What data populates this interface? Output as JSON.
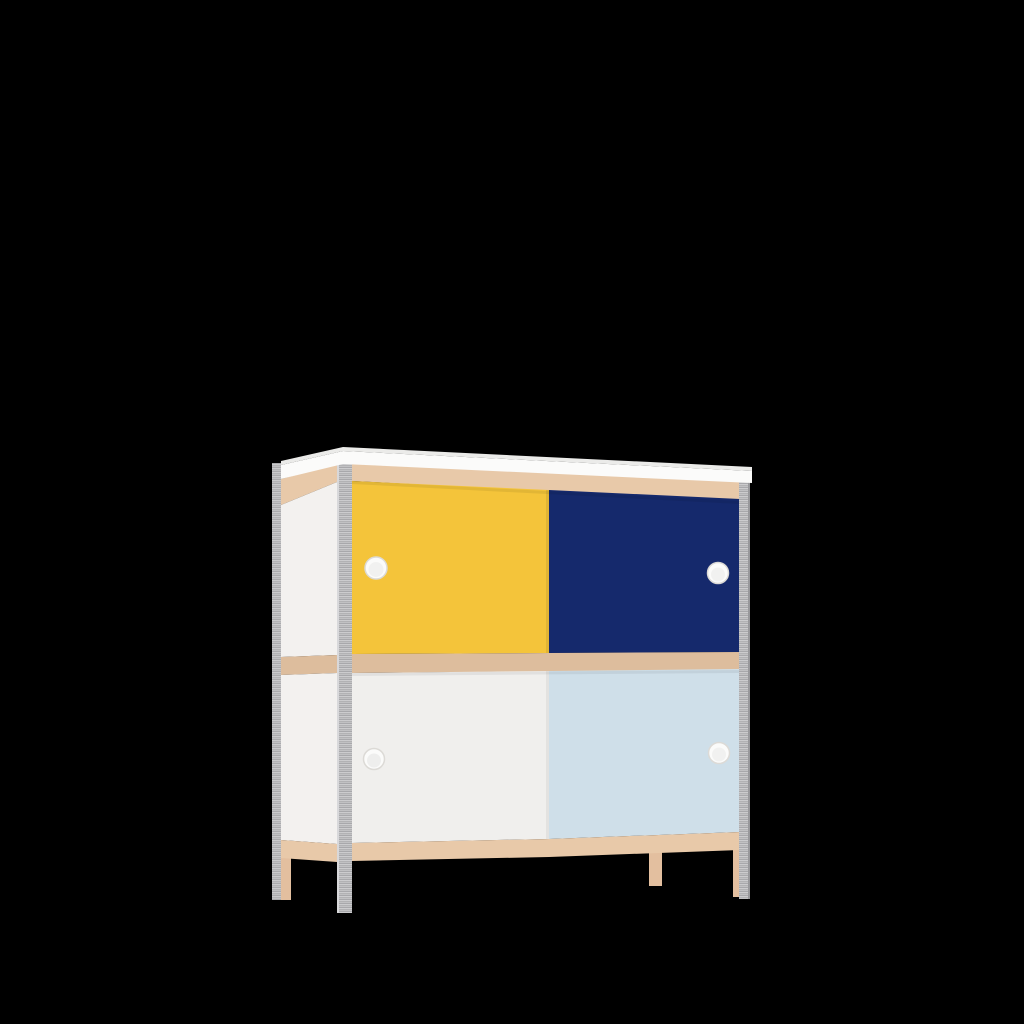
{
  "scene": {
    "type": "3d-product-render",
    "object": "two-tier sideboard cabinet with four sliding doors, birch-plywood rails and galvanized steel corner posts, floating on a plain black background",
    "background_color": "#000000"
  },
  "cabinet": {
    "structure": {
      "rows": 2,
      "doors_per_row": 2,
      "handle_style": "round white finger pull",
      "legs": 4,
      "view": "front-left three-quarter perspective"
    },
    "materials": {
      "top_surface": "#fbfbfa",
      "top_edge": "#ebebe9",
      "rail_wood": "#e8c9a9",
      "rail_wood_dark": "#ddbd9d",
      "side_panel": "#f3f1ef",
      "steel": "#b9b9bb",
      "steel_light": "#d8d8da",
      "steel_dark": "#98989b",
      "leg_wood": "#e3bf9f",
      "handle": "#fbfbfa",
      "handle_rim": "#dcdad6"
    },
    "doors": [
      {
        "id": "top-left",
        "color_name": "yellow",
        "color": "#f4c43a"
      },
      {
        "id": "top-right",
        "color_name": "navy-blue",
        "color": "#15296c"
      },
      {
        "id": "bottom-left",
        "color_name": "white",
        "color": "#f0efed"
      },
      {
        "id": "bottom-right",
        "color_name": "light-blue",
        "color": "#cfdfe9"
      }
    ]
  }
}
